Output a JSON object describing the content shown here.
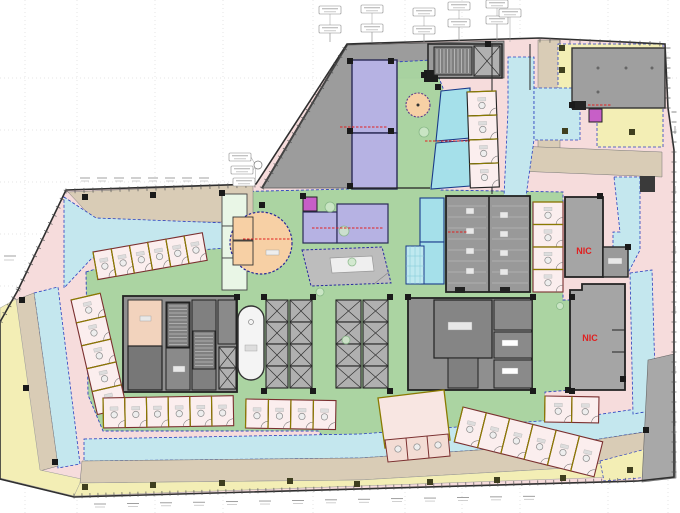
{
  "plan": {
    "annotations": {
      "nic_1": "NIC",
      "nic_2": "NIC"
    },
    "palette": {
      "paper": "#ffffff",
      "circulation_green": "#a9d4a1",
      "office_pink": "#f6dcdc",
      "room_pink_light": "#fbeeee",
      "corridor_cyan": "#c4e7ee",
      "conference_cyan": "#a5e0ea",
      "perimeter_yellow": "#f3eeb5",
      "terrace_tan": "#d9ccb6",
      "terrace_gray": "#9c9c9c",
      "core_gray": "#8f8f8f",
      "core_mid": "#858585",
      "nic_gray": "#a5a5a5",
      "residential_purple": "#b6b2e3",
      "accent_magenta": "#c75fc7",
      "feature_orange": "#f7d0a5",
      "mint": "#e9f6e6",
      "peach": "#f2d3bd",
      "annotation_red": "#e02020",
      "boundary_blue": "#2a3fbf",
      "wall_dark": "#333333",
      "partition_maroon": "#7a2f2f",
      "edge_olive": "#8a7a00"
    }
  }
}
